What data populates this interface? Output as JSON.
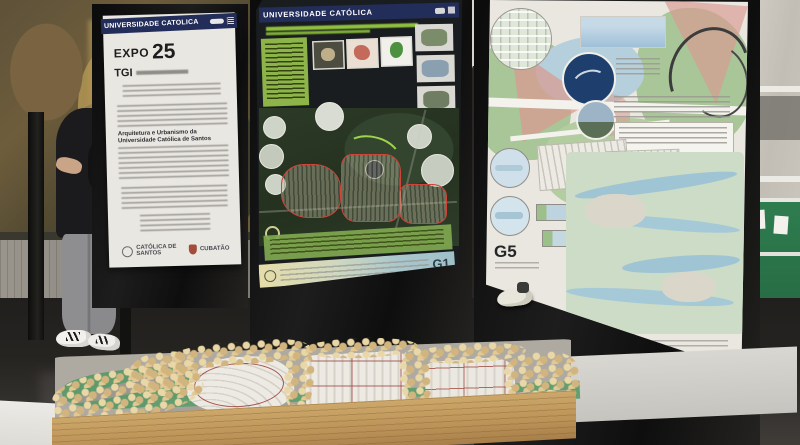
{
  "posters": {
    "left": {
      "university_banner": "UNIVERSIDADE CATÓLICA",
      "title": "EXPO",
      "year": "25",
      "program": "TGI",
      "body_bold": "Arquitetura e Urbanismo da Universidade Católica de Santos",
      "logo_left": "CATÓLICA DE SANTOS",
      "logo_right": "CUBATÃO"
    },
    "middle": {
      "university_banner": "UNIVERSIDADE CATÓLICA",
      "group_badge": "G1"
    },
    "right": {
      "group_badge": "G5"
    }
  },
  "colors": {
    "banner_navy": "#232d5a",
    "poster_green": "#8fbf3f",
    "plan_green": "#a9c698",
    "plan_pink": "#d99a94",
    "model_tree": "#e3cf9e"
  }
}
